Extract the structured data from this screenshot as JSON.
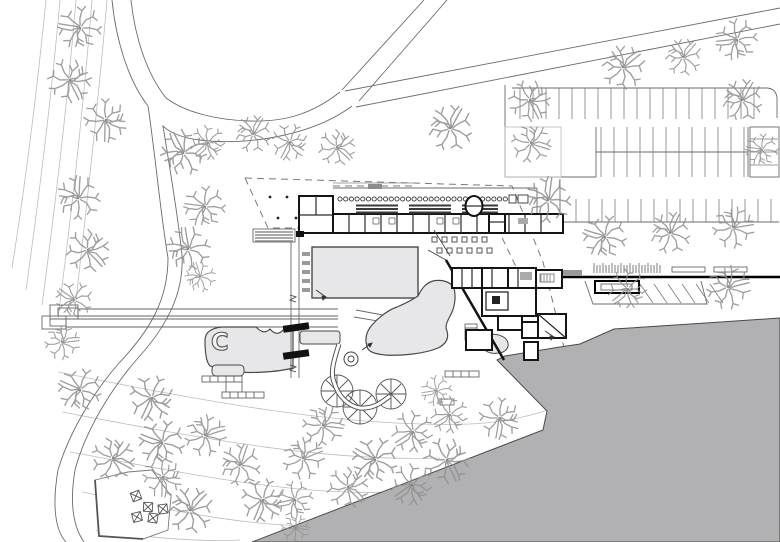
{
  "plan": {
    "pool_feature_label": "C"
  },
  "colors": {
    "paper": "#ffffff",
    "lake": "#b1b1b3",
    "pool": "#e7e7e9",
    "wall": "#141414",
    "line": "#6b6b6b",
    "light": "#bdbdbd",
    "tree": "#8f8f8f",
    "gray_block": "#8c8c8c",
    "dash": "#7a7a7a"
  },
  "trees": [
    [
      80,
      28,
      20
    ],
    [
      70,
      80,
      20
    ],
    [
      106,
      120,
      20
    ],
    [
      78,
      198,
      20
    ],
    [
      88,
      250,
      20
    ],
    [
      74,
      300,
      17
    ],
    [
      62,
      342,
      16
    ],
    [
      183,
      153,
      21
    ],
    [
      205,
      207,
      19
    ],
    [
      188,
      249,
      20
    ],
    [
      208,
      143,
      16
    ],
    [
      253,
      134,
      17
    ],
    [
      290,
      142,
      17
    ],
    [
      337,
      147,
      17
    ],
    [
      450,
      128,
      21
    ],
    [
      530,
      100,
      19
    ],
    [
      623,
      67,
      20
    ],
    [
      683,
      57,
      17
    ],
    [
      737,
      40,
      19
    ],
    [
      742,
      100,
      19
    ],
    [
      531,
      143,
      18
    ],
    [
      762,
      150,
      15
    ],
    [
      548,
      200,
      21
    ],
    [
      605,
      237,
      20
    ],
    [
      670,
      233,
      19
    ],
    [
      733,
      227,
      19
    ],
    [
      628,
      289,
      18
    ],
    [
      728,
      287,
      20
    ],
    [
      200,
      277,
      14
    ],
    [
      80,
      390,
      20
    ],
    [
      152,
      398,
      21
    ],
    [
      113,
      458,
      20
    ],
    [
      162,
      443,
      21
    ],
    [
      205,
      435,
      19
    ],
    [
      240,
      465,
      19
    ],
    [
      163,
      477,
      18
    ],
    [
      190,
      510,
      21
    ],
    [
      263,
      500,
      20
    ],
    [
      303,
      458,
      19
    ],
    [
      323,
      425,
      19
    ],
    [
      375,
      460,
      21
    ],
    [
      413,
      432,
      19
    ],
    [
      447,
      460,
      21
    ],
    [
      348,
      487,
      19
    ],
    [
      412,
      485,
      19
    ],
    [
      450,
      415,
      17
    ],
    [
      500,
      418,
      19
    ],
    [
      295,
      500,
      17
    ],
    [
      295,
      528,
      13
    ],
    [
      437,
      391,
      14
    ]
  ],
  "parking_rows": [
    {
      "x1": 520,
      "x2": 766,
      "y": 88,
      "tick": 31,
      "step": 13
    },
    {
      "x1": 601,
      "x2": 744,
      "y": 152,
      "tick": -25,
      "step": 13
    },
    {
      "x1": 601,
      "x2": 744,
      "y": 152,
      "tick": 25,
      "step": 13
    },
    {
      "x1": 576,
      "x2": 776,
      "y": 222,
      "tick": -23,
      "step": 13
    },
    {
      "horiz": true,
      "x": 750,
      "tick": 28,
      "y1": 139,
      "y2": 166,
      "step": 13
    }
  ],
  "bike_rack": {
    "x1": 594,
    "x2": 662,
    "y1": 265,
    "y2": 273,
    "step": 3
  },
  "ramp_hatch": {
    "x": 640,
    "y": 284,
    "count": 6,
    "step": 14,
    "dx": 13,
    "dy": 19
  },
  "lockers": {
    "x1": 340,
    "x2": 506,
    "y": 199,
    "step": 5.7,
    "r": 2.1
  },
  "plaza_dots": [
    [
      270,
      197
    ],
    [
      287,
      197
    ],
    [
      304,
      197
    ],
    [
      278,
      218
    ],
    [
      296,
      218
    ]
  ],
  "terrace_tables": {
    "size": 5,
    "rows": [
      {
        "y": 237,
        "xs": [
          432,
          442,
          452,
          462,
          472,
          482
        ]
      },
      {
        "y": 248,
        "xs": [
          437,
          447,
          457,
          467,
          477,
          487
        ]
      }
    ]
  },
  "playground_marks": [
    [
      136,
      496
    ],
    [
      148,
      507
    ],
    [
      137,
      517
    ],
    [
      153,
      518
    ],
    [
      163,
      509
    ]
  ]
}
